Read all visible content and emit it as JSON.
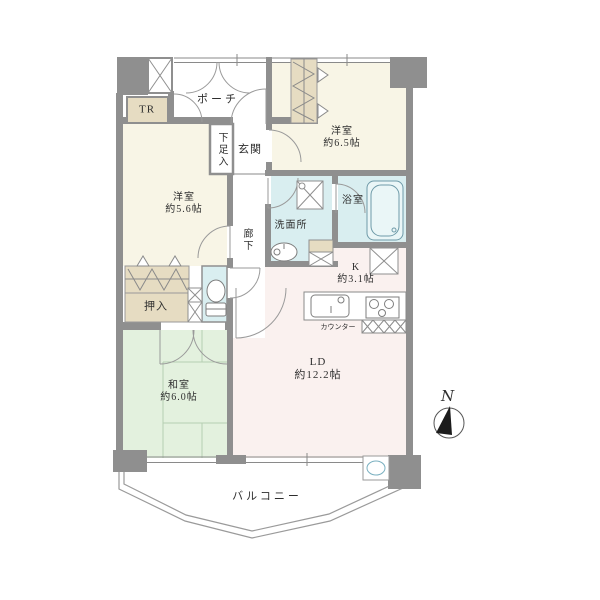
{
  "plan": {
    "type": "apartment-floor-plan",
    "rooms": {
      "porch": {
        "label": "ポーチ"
      },
      "trunk_room": {
        "label": "TR"
      },
      "shoe_cabinet": {
        "label": "下足入"
      },
      "entrance": {
        "label": "玄関"
      },
      "western_6_5": {
        "label": "洋室",
        "area": "約6.5帖"
      },
      "western_5_6": {
        "label": "洋室",
        "area": "約5.6帖"
      },
      "corridor": {
        "label": "廊下"
      },
      "washroom": {
        "label": "洗面所"
      },
      "bathroom": {
        "label": "浴室"
      },
      "kitchen": {
        "label": "K",
        "area": "約3.1帖"
      },
      "counter": {
        "label": "カウンター"
      },
      "closet": {
        "label": "押入"
      },
      "japanese_6_0": {
        "label": "和室",
        "area": "約6.0帖"
      },
      "living_dining": {
        "label": "LD",
        "area": "約12.2帖"
      },
      "balcony": {
        "label": "バルコニー"
      }
    },
    "compass": {
      "north_label": "N"
    },
    "colors": {
      "western_room_fill": "#f8f5e6",
      "japanese_room_fill": "#e3f1de",
      "living_dining_fill": "#faf1ef",
      "wet_area_fill": "#d9eef0",
      "storage_fill": "#e6dcc2",
      "wall_gray": "#8f8f8f"
    }
  }
}
